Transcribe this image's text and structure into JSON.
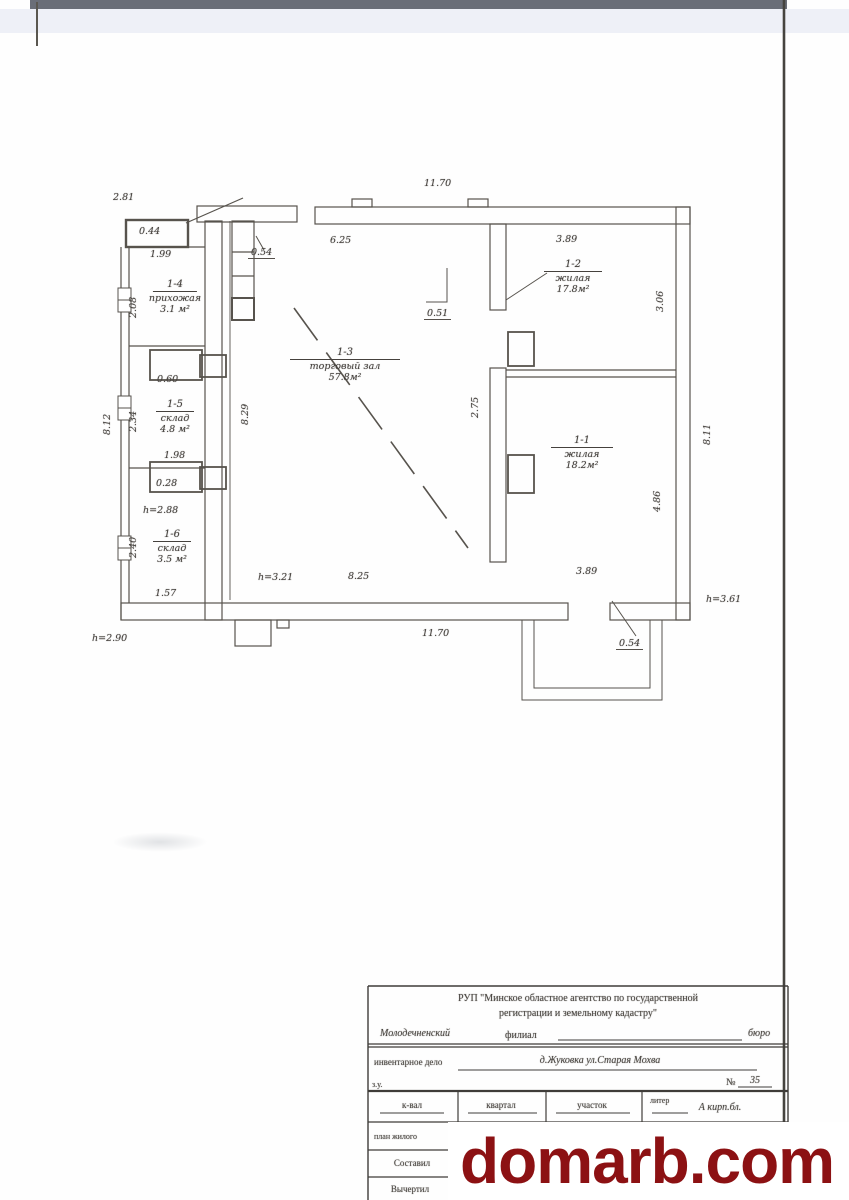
{
  "watermark": {
    "text": "domarb.com",
    "color": "#8c1113"
  },
  "plan": {
    "rooms": [
      {
        "id": "1-4",
        "name": "прихожая",
        "area": "3.1 м²",
        "x": 175,
        "y": 272,
        "bar": 44
      },
      {
        "id": "1-5",
        "name": "склад",
        "area": "4.8 м²",
        "x": 175,
        "y": 392,
        "bar": 38
      },
      {
        "id": "1-6",
        "name": "склад",
        "area": "3.5 м²",
        "x": 172,
        "y": 522,
        "bar": 38
      },
      {
        "id": "1-3",
        "name": "торговый зал",
        "area": "57.8м²",
        "x": 345,
        "y": 340,
        "bar": 110
      },
      {
        "id": "1-2",
        "name": "жилая",
        "area": "17.8м²",
        "x": 573,
        "y": 252,
        "bar": 58
      },
      {
        "id": "1-1",
        "name": "жилая",
        "area": "18.2м²",
        "x": 582,
        "y": 428,
        "bar": 62
      }
    ],
    "dims": [
      {
        "t": "2.81",
        "x": 113,
        "y": 192
      },
      {
        "t": "0.44",
        "x": 139,
        "y": 226
      },
      {
        "t": "1.99",
        "x": 150,
        "y": 249
      },
      {
        "t": "0.54",
        "x": 248,
        "y": 247,
        "u": 1
      },
      {
        "t": "6.25",
        "x": 330,
        "y": 235
      },
      {
        "t": "11.70",
        "x": 424,
        "y": 178
      },
      {
        "t": "3.89",
        "x": 556,
        "y": 234
      },
      {
        "t": "3.06",
        "x": 655,
        "y": 312,
        "r": 1
      },
      {
        "t": "0.51",
        "x": 424,
        "y": 308,
        "u": 1
      },
      {
        "t": "2.75",
        "x": 470,
        "y": 418,
        "r": 1
      },
      {
        "t": "4.86",
        "x": 652,
        "y": 512,
        "r": 1
      },
      {
        "t": "8.11",
        "x": 702,
        "y": 445,
        "r": 1
      },
      {
        "t": "8.29",
        "x": 240,
        "y": 425,
        "r": 1
      },
      {
        "t": "2.08",
        "x": 128,
        "y": 318,
        "r": 1
      },
      {
        "t": "2.34",
        "x": 128,
        "y": 432,
        "r": 1
      },
      {
        "t": "2.40",
        "x": 128,
        "y": 558,
        "r": 1
      },
      {
        "t": "8.12",
        "x": 102,
        "y": 435,
        "r": 1
      },
      {
        "t": "0.60",
        "x": 157,
        "y": 374
      },
      {
        "t": "1.98",
        "x": 164,
        "y": 450
      },
      {
        "t": "0.28",
        "x": 156,
        "y": 478
      },
      {
        "t": "h=2.88",
        "x": 143,
        "y": 505
      },
      {
        "t": "1.57",
        "x": 155,
        "y": 588
      },
      {
        "t": "h=2.90",
        "x": 92,
        "y": 633
      },
      {
        "t": "h=3.21",
        "x": 258,
        "y": 572
      },
      {
        "t": "8.25",
        "x": 348,
        "y": 571
      },
      {
        "t": "11.70",
        "x": 422,
        "y": 628
      },
      {
        "t": "3.89",
        "x": 576,
        "y": 566
      },
      {
        "t": "0.54",
        "x": 616,
        "y": 638,
        "u": 1
      },
      {
        "t": "h=3.61",
        "x": 706,
        "y": 594
      }
    ]
  },
  "title_block": {
    "agency_line1": "РУП \"Минское областное агентство по государственной",
    "agency_line2": "регистрации и земельному кадастру\"",
    "branch_left": "Молодечненский",
    "branch_mid": "филиал",
    "branch_right": "бюро",
    "inventory_label": "инвентарное дело",
    "address": "д.Жуковка   ул.Старая  Мохва",
    "zu": "з.у.",
    "number_label": "№",
    "number_value": "35",
    "col_kvartal_short": "к-вал",
    "col_kvartal": "квартал",
    "col_uchastok": "участок",
    "col_liter": "литер",
    "liter_value": "А кирп.бл.",
    "row_plan": "план жилого",
    "row_sostavil": "Составил",
    "row_vychertil": "Вычертил"
  }
}
